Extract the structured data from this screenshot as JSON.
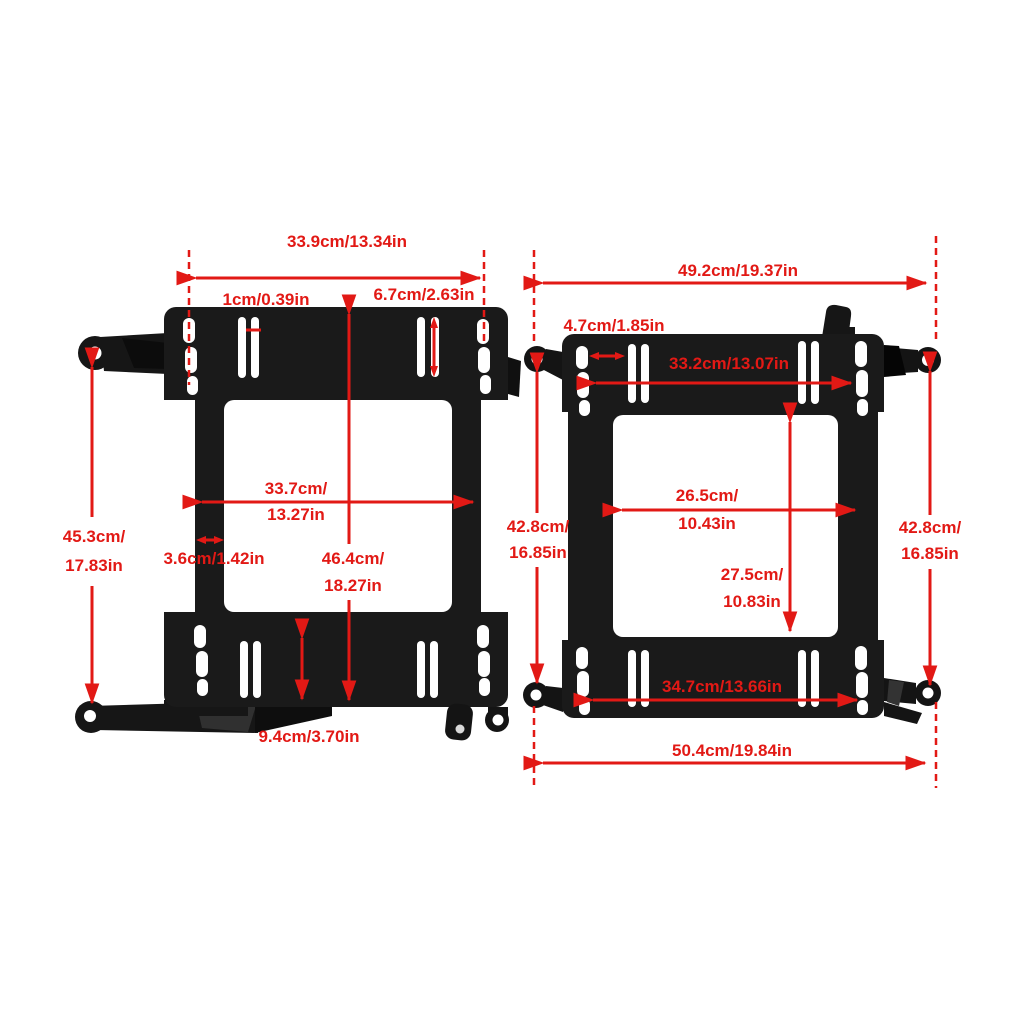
{
  "figure": {
    "type": "product-dimension-diagram",
    "description": "Two black seat mounting bracket adapter plates shown side by side with red dimension arrows and measurement labels",
    "background_color": "#ffffff",
    "annotation_color": "#e21915",
    "bracket_color": "#1a1a1a",
    "hole_color": "#ffffff"
  },
  "left_bracket": {
    "top_width": "33.9cm/13.34in",
    "slot_width": "1cm/0.39in",
    "slot_height": "6.7cm/2.63in",
    "inner_width_line1": "33.7cm/",
    "inner_width_line2": "13.27in",
    "rail_width": "3.6cm/1.42in",
    "overall_height_line1": "46.4cm/",
    "overall_height_line2": "18.27in",
    "side_height_line1": "45.3cm/",
    "side_height_line2": "17.83in",
    "flange_height": "9.4cm/3.70in"
  },
  "right_bracket": {
    "top_width": "49.2cm/19.37in",
    "slot_spacing": "4.7cm/1.85in",
    "top_slot_span": "33.2cm/13.07in",
    "inner_width_line1": "26.5cm/",
    "inner_width_line2": "10.43in",
    "inner_height_line1": "27.5cm/",
    "inner_height_line2": "10.83in",
    "left_height_line1": "42.8cm/",
    "left_height_line2": "16.85in",
    "right_height_line1": "42.8cm/",
    "right_height_line2": "16.85in",
    "bottom_slot_span": "34.7cm/13.66in",
    "bottom_width": "50.4cm/19.84in"
  }
}
